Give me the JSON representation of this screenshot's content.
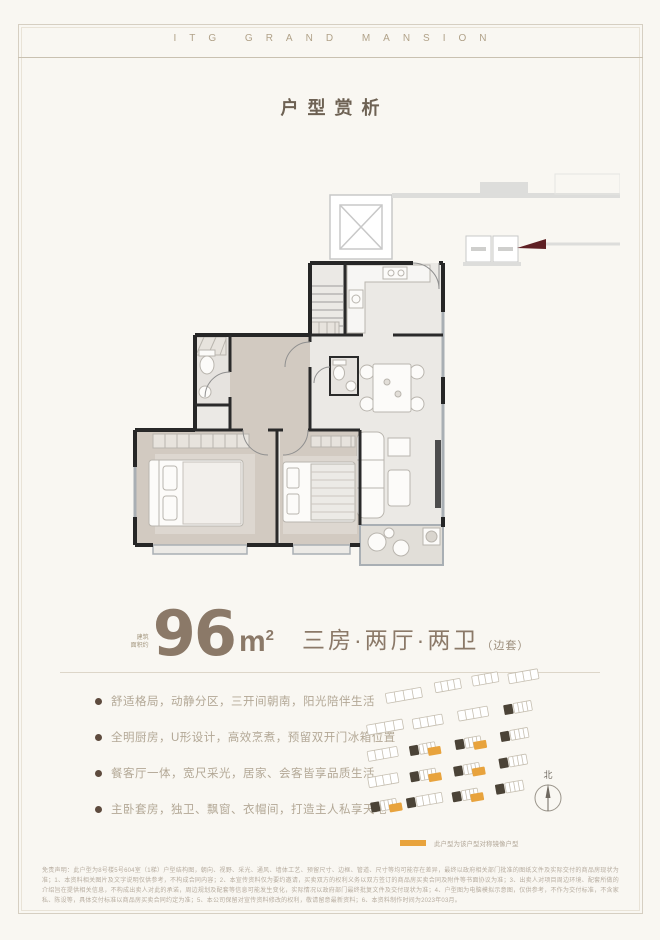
{
  "brand": {
    "logo_text": "ITG GRAND MANSION"
  },
  "header": {
    "page_title": "户型赏析"
  },
  "unit": {
    "area_prefix_line1": "建筑",
    "area_prefix_line2": "面积约",
    "area_value": "96",
    "area_unit_base": "m",
    "area_unit_sup": "2",
    "layout_text": "三房·两厅·两卫",
    "layout_tag": "（边套）"
  },
  "features": [
    "舒适格局，动静分区，三开间朝南，阳光陪伴生活",
    "全明厨房，U形设计，高效烹煮，预留双开门冰箱位置",
    "餐客厅一体，宽尺采光，居家、会客皆享品质生活",
    "主卧套房，独卫、飘窗、衣帽间，打造主人私享天地"
  ],
  "site_plan": {
    "compass_label": "北",
    "legend_text": "此户型为该户型对称镜像户型",
    "legend_color": "#e8a33d",
    "highlight_dark_color": "#4b4337"
  },
  "floor_plan": {
    "entry_marker_color": "#5f2024",
    "wall_color": "#262626",
    "window_color": "#a9afb4"
  },
  "colors": {
    "background": "#f9f7f2",
    "brand_gold": "#b1a289",
    "area_brown": "#8b7968",
    "feature_text": "#b3a896",
    "frame_line": "#d6cfc2"
  },
  "disclaimer": "免责声明：此户型为8号楼5号604室（1梯）户型结构图，朝向、视野、采光、通风、墙体工艺、预留尺寸、边框、管道、尺寸等均可能存在差异，最终以政府相关部门批准的图纸文件及实际交付的商品房现状为准；1、本资料相关图片及文字说明仅供参考，不构成合同内容；2、本宣传资料仅为要约邀请，买卖双方的权利义务以双方签订的商品房买卖合同及附件等书面协议为准；3、出卖人对项目周边环境、配套所做的介绍旨在提供相关信息，不构成出卖人对此的承诺，周边规划及配套等信息可能发生变化，实际情况以政府部门最终批复文件及交付现状为准；4、户型图为电脑模拟示意图，仅供参考，不作为交付标准，不含家私、陈设等，具体交付标准以商品房买卖合同约定为准；5、本公司保留对宣传资料修改的权利，敬请留意最新资料；6、本资料制作时间为2023年03月。"
}
